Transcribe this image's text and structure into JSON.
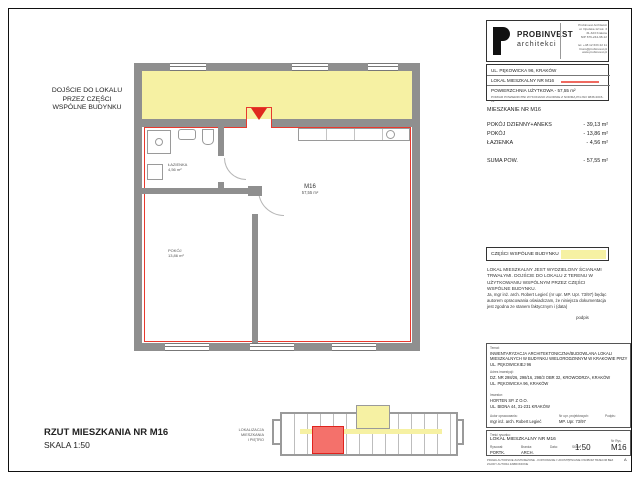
{
  "colors": {
    "common_yellow": "#f6f1a3",
    "lokal_red": "#e8392e",
    "unit_fill_red": "#f4716b",
    "wall_gray": "#8f8f8f"
  },
  "logo": {
    "name": "PROBINVEST",
    "sub": "architekci",
    "contact_top": [
      "Probinvest Architekci",
      "ul. Opolska 12 lok. 3",
      "31-323 Kraków",
      "NIP 676-244-98-12"
    ],
    "contact_bottom": [
      "tel. +48 12 633 22 11",
      "biuro@probinvest.pl",
      "www.probinvest.pl"
    ]
  },
  "info_box": {
    "address": "UL. PĘKOWICKA 96, KRAKÓW",
    "lokal": "LOKAL MIESZKALNY NR M16",
    "area_line": "POWIERZCHNIA UŻYTKOWA - 57,55 m²",
    "area_note": "POMIAR POWIERZCHNI WYKONANO ZGODNIE Z NORMĄ PN-ISO 9836:2015-12"
  },
  "rooms": {
    "header": "MIESZKANIE NR M16",
    "rows": [
      {
        "label": "POKÓJ DZIENNY+ANEKS",
        "value": "- 39,13 m²"
      },
      {
        "label": "POKÓJ",
        "value": "- 13,86 m²"
      },
      {
        "label": "ŁAZIENKA",
        "value": "- 4,56 m²"
      }
    ],
    "sum_label": "SUMA POW.",
    "sum_value": "- 57,55 m²"
  },
  "legend": {
    "common_label": "CZĘŚCI WSPÓLNE BUDYNKU"
  },
  "statement": {
    "p1": "LOKAL MIESZKALNY JEST WYDZIELONY ŚCIANAMI TRWAŁYMI. DOJŚCIE DO LOKALU Z TERENU W UŻYTKOWANIU WSPÓLNYM PRZEZ CZĘŚCI WSPÓLNE BUDYNKU.",
    "p2": "Ja, mgr inż. arch. Robert Legieć (nr upr. MP. Upr. 73/97) będąc autorem opracowania oświadczam, że niniejsza dokumentacja jest zgodna ze stanem faktycznym i (data)",
    "signature": "podpis"
  },
  "project_block": {
    "temat_label": "Temat:",
    "temat": "INWENTARYZACJA ARCHITEKTONICZNA/BUDOWLANA LOKALI MIESZKALNYCH W BUDYNKU WIELORODZINNYM W KRAKOWIE PRZY UL. PĘKOWICKIEJ 96",
    "adres_label": "Adres inwestycji:",
    "adres1": "DZ. NR 298/26, 298/16, 298/3 OBR 32, KROWODRZA, KRAKÓW",
    "adres2": "UL. PĘKOWICKA 96, KRAKÓW",
    "inwestor_label": "Inwestor:",
    "inwestor1": "HORTEN SP. Z O.O.",
    "inwestor2": "UL. BIDNA 44, 31-231 KRAKÓW",
    "autor_label": "Autor opracowania:",
    "autor": "mgr inż. arch. Robert Legieć",
    "upr_label": "Nr upr. projektowych:",
    "upr": "MP. Upr. 73/97",
    "podpis_label": "Podpis:"
  },
  "drawing_block": {
    "tresc_label": "Treść rysunku:",
    "tresc": "LOKAL MIESZKALNY NR M16",
    "rysowal_label": "Rysował:",
    "rysowal": "PORTK.",
    "branza_label": "Branża:",
    "branza": "ARCH.",
    "data_label": "Data:",
    "skala_label": "Skala:",
    "skala": "1:50",
    "nr_label": "Nr Rys.",
    "nr": "M16",
    "footnote": "PRAWA AUTORSKIE ZASTRZEŻONE - KOPIOWANIE I UDOSTĘPNIANIE OSOBOM TRZECIM BEZ ZGODY AUTORA ZABRONIONE",
    "format": "A"
  },
  "plan": {
    "access_label_lines": [
      "DOJŚCIE DO LOKALU",
      "PRZEZ CZĘŚCI",
      "WSPÓLNE BUDYNKU"
    ],
    "unit_label": "M16",
    "unit_area": "57,55 m²",
    "bathroom_label": "ŁAZIENKA",
    "bathroom_area": "4,56 m²",
    "bedroom_label": "POKÓJ",
    "bedroom_area": "13,86 m²"
  },
  "footer": {
    "title": "RZUT MIESZKANIA NR M16",
    "scale": "SKALA 1:50",
    "keyplan_lines": [
      "LOKALIZACJA",
      "MIESZKANIA",
      "I PIĘTRO"
    ]
  }
}
